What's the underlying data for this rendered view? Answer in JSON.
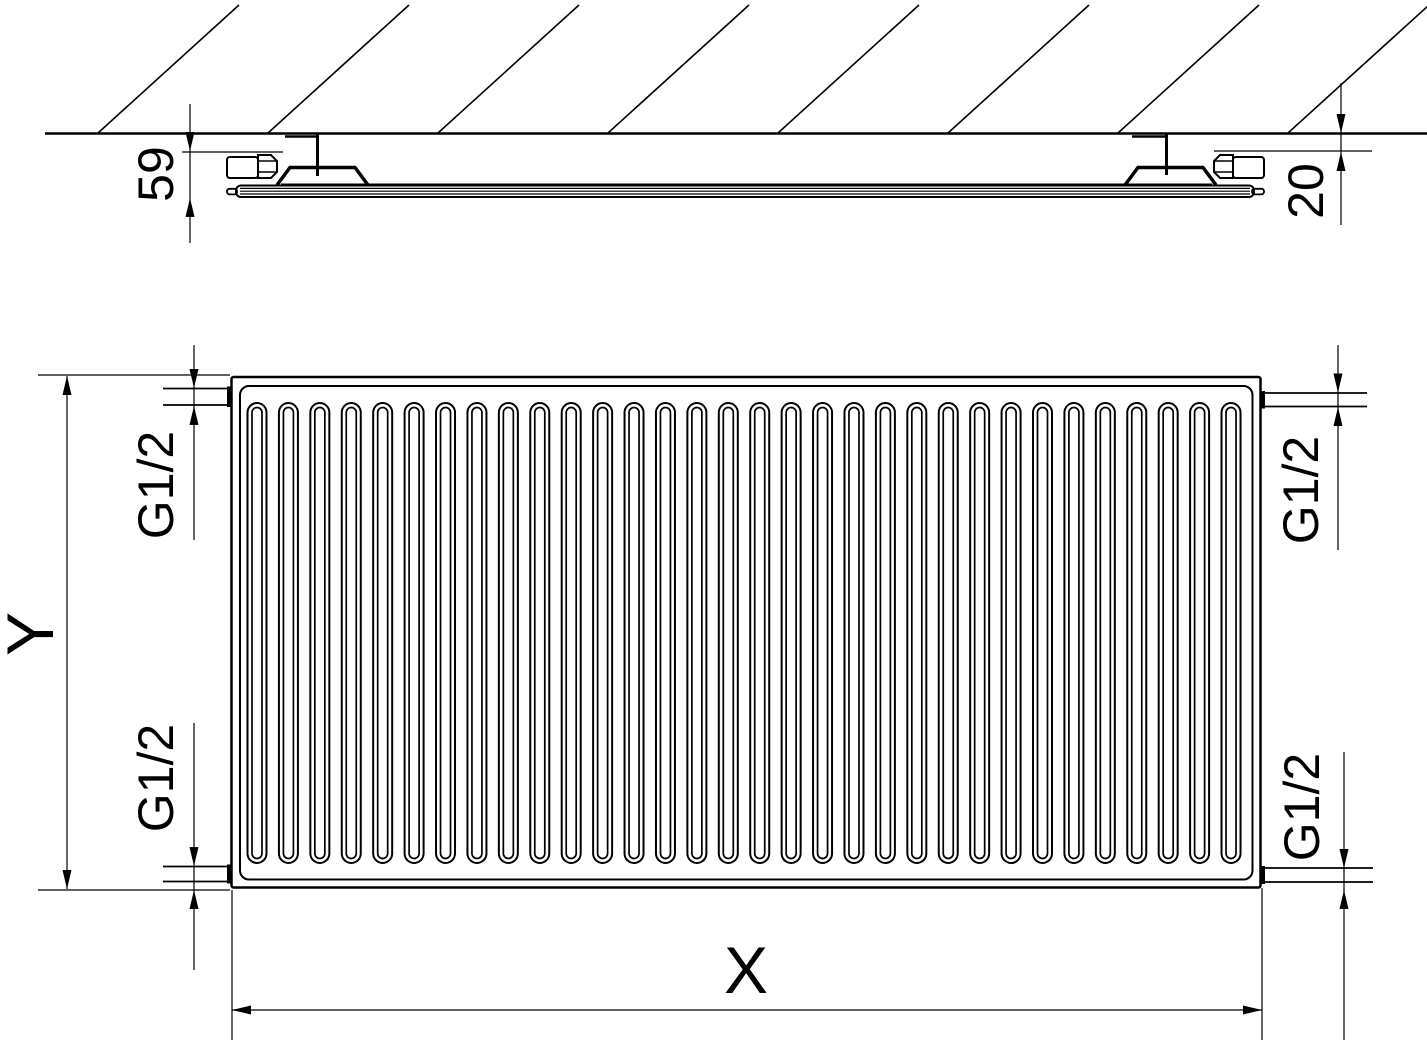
{
  "title": "Panel radiator technical dimension drawing",
  "labels": {
    "depth": "59",
    "wall_gap": "20",
    "height": "Y",
    "width": "X",
    "connection_top_left": "G1/2",
    "connection_bottom_left": "G1/2",
    "connection_top_right": "G1/2",
    "connection_bottom_right": "G1/2"
  },
  "front_view": {
    "channel_count": 32,
    "channel_first_center_x": 257,
    "channel_spacing": 31.42
  },
  "colors": {
    "line": "#000000",
    "background": "#ffffff"
  }
}
